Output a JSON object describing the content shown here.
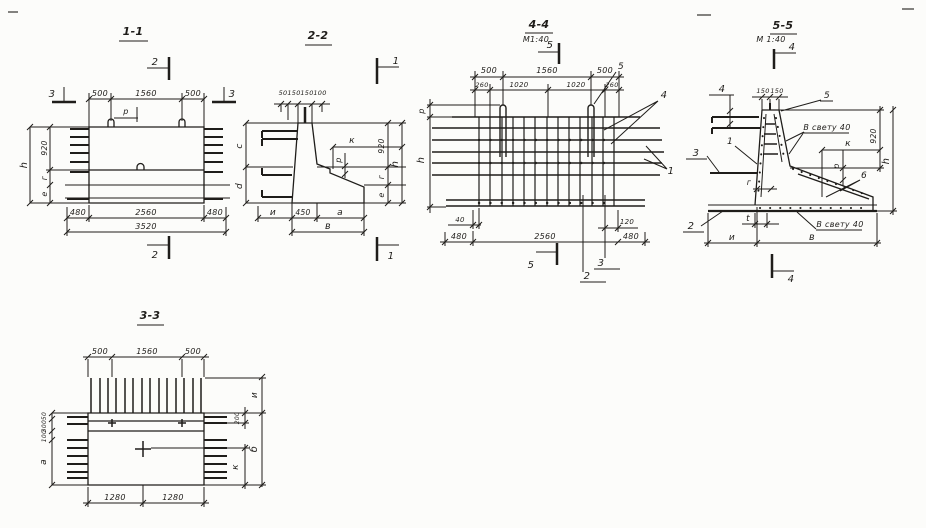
{
  "colors": {
    "ink": "#1f1d1a",
    "paper": "#fcfcfa"
  },
  "s11": {
    "title": "1-1",
    "marker2": "2",
    "marker3": "3",
    "top": [
      "500",
      "1560",
      "500"
    ],
    "loop": "р",
    "left": [
      "920",
      "г",
      "е",
      "h"
    ],
    "bottom": [
      "480",
      "2560",
      "480"
    ],
    "total": "3520"
  },
  "s22": {
    "title": "2-2",
    "marker1": "1",
    "top": [
      "50",
      "150",
      "150",
      "100"
    ],
    "left": [
      "c",
      "d"
    ],
    "mid": [
      "к",
      "р"
    ],
    "right": [
      "920",
      "г",
      "е",
      "h"
    ],
    "bottom": [
      "и",
      "450",
      "а",
      "в"
    ]
  },
  "s33": {
    "title": "3-3",
    "top": [
      "500",
      "1560",
      "500"
    ],
    "left": [
      "50",
      "300",
      "100",
      "а"
    ],
    "right": [
      "и",
      "200",
      "б",
      "к"
    ],
    "bottom": [
      "1280",
      "1280"
    ]
  },
  "s44": {
    "title": "4-4",
    "scale": "М1:40",
    "marker5": "5",
    "marker3": "3",
    "marker2": "2",
    "callout5": "5",
    "callout4": "4",
    "callout1": "1",
    "top": [
      "500",
      "1560",
      "500"
    ],
    "top2": [
      "260",
      "1020",
      "1020",
      "260"
    ],
    "left": [
      "р",
      "h"
    ],
    "small": [
      "40",
      "120"
    ],
    "bottom": [
      "480",
      "2560",
      "480"
    ]
  },
  "s55": {
    "title": "5-5",
    "scale": "М 1:40",
    "marker4": "4",
    "callout4": "4",
    "callout5": "5",
    "callout1": "1",
    "callout3": "3",
    "callout2": "2",
    "callout6": "6",
    "note": "В свету 40",
    "top": [
      "150",
      "150"
    ],
    "right": [
      "920",
      "h"
    ],
    "mid": [
      "к",
      "р",
      "г",
      "t"
    ],
    "bottom": [
      "и",
      "в"
    ]
  }
}
